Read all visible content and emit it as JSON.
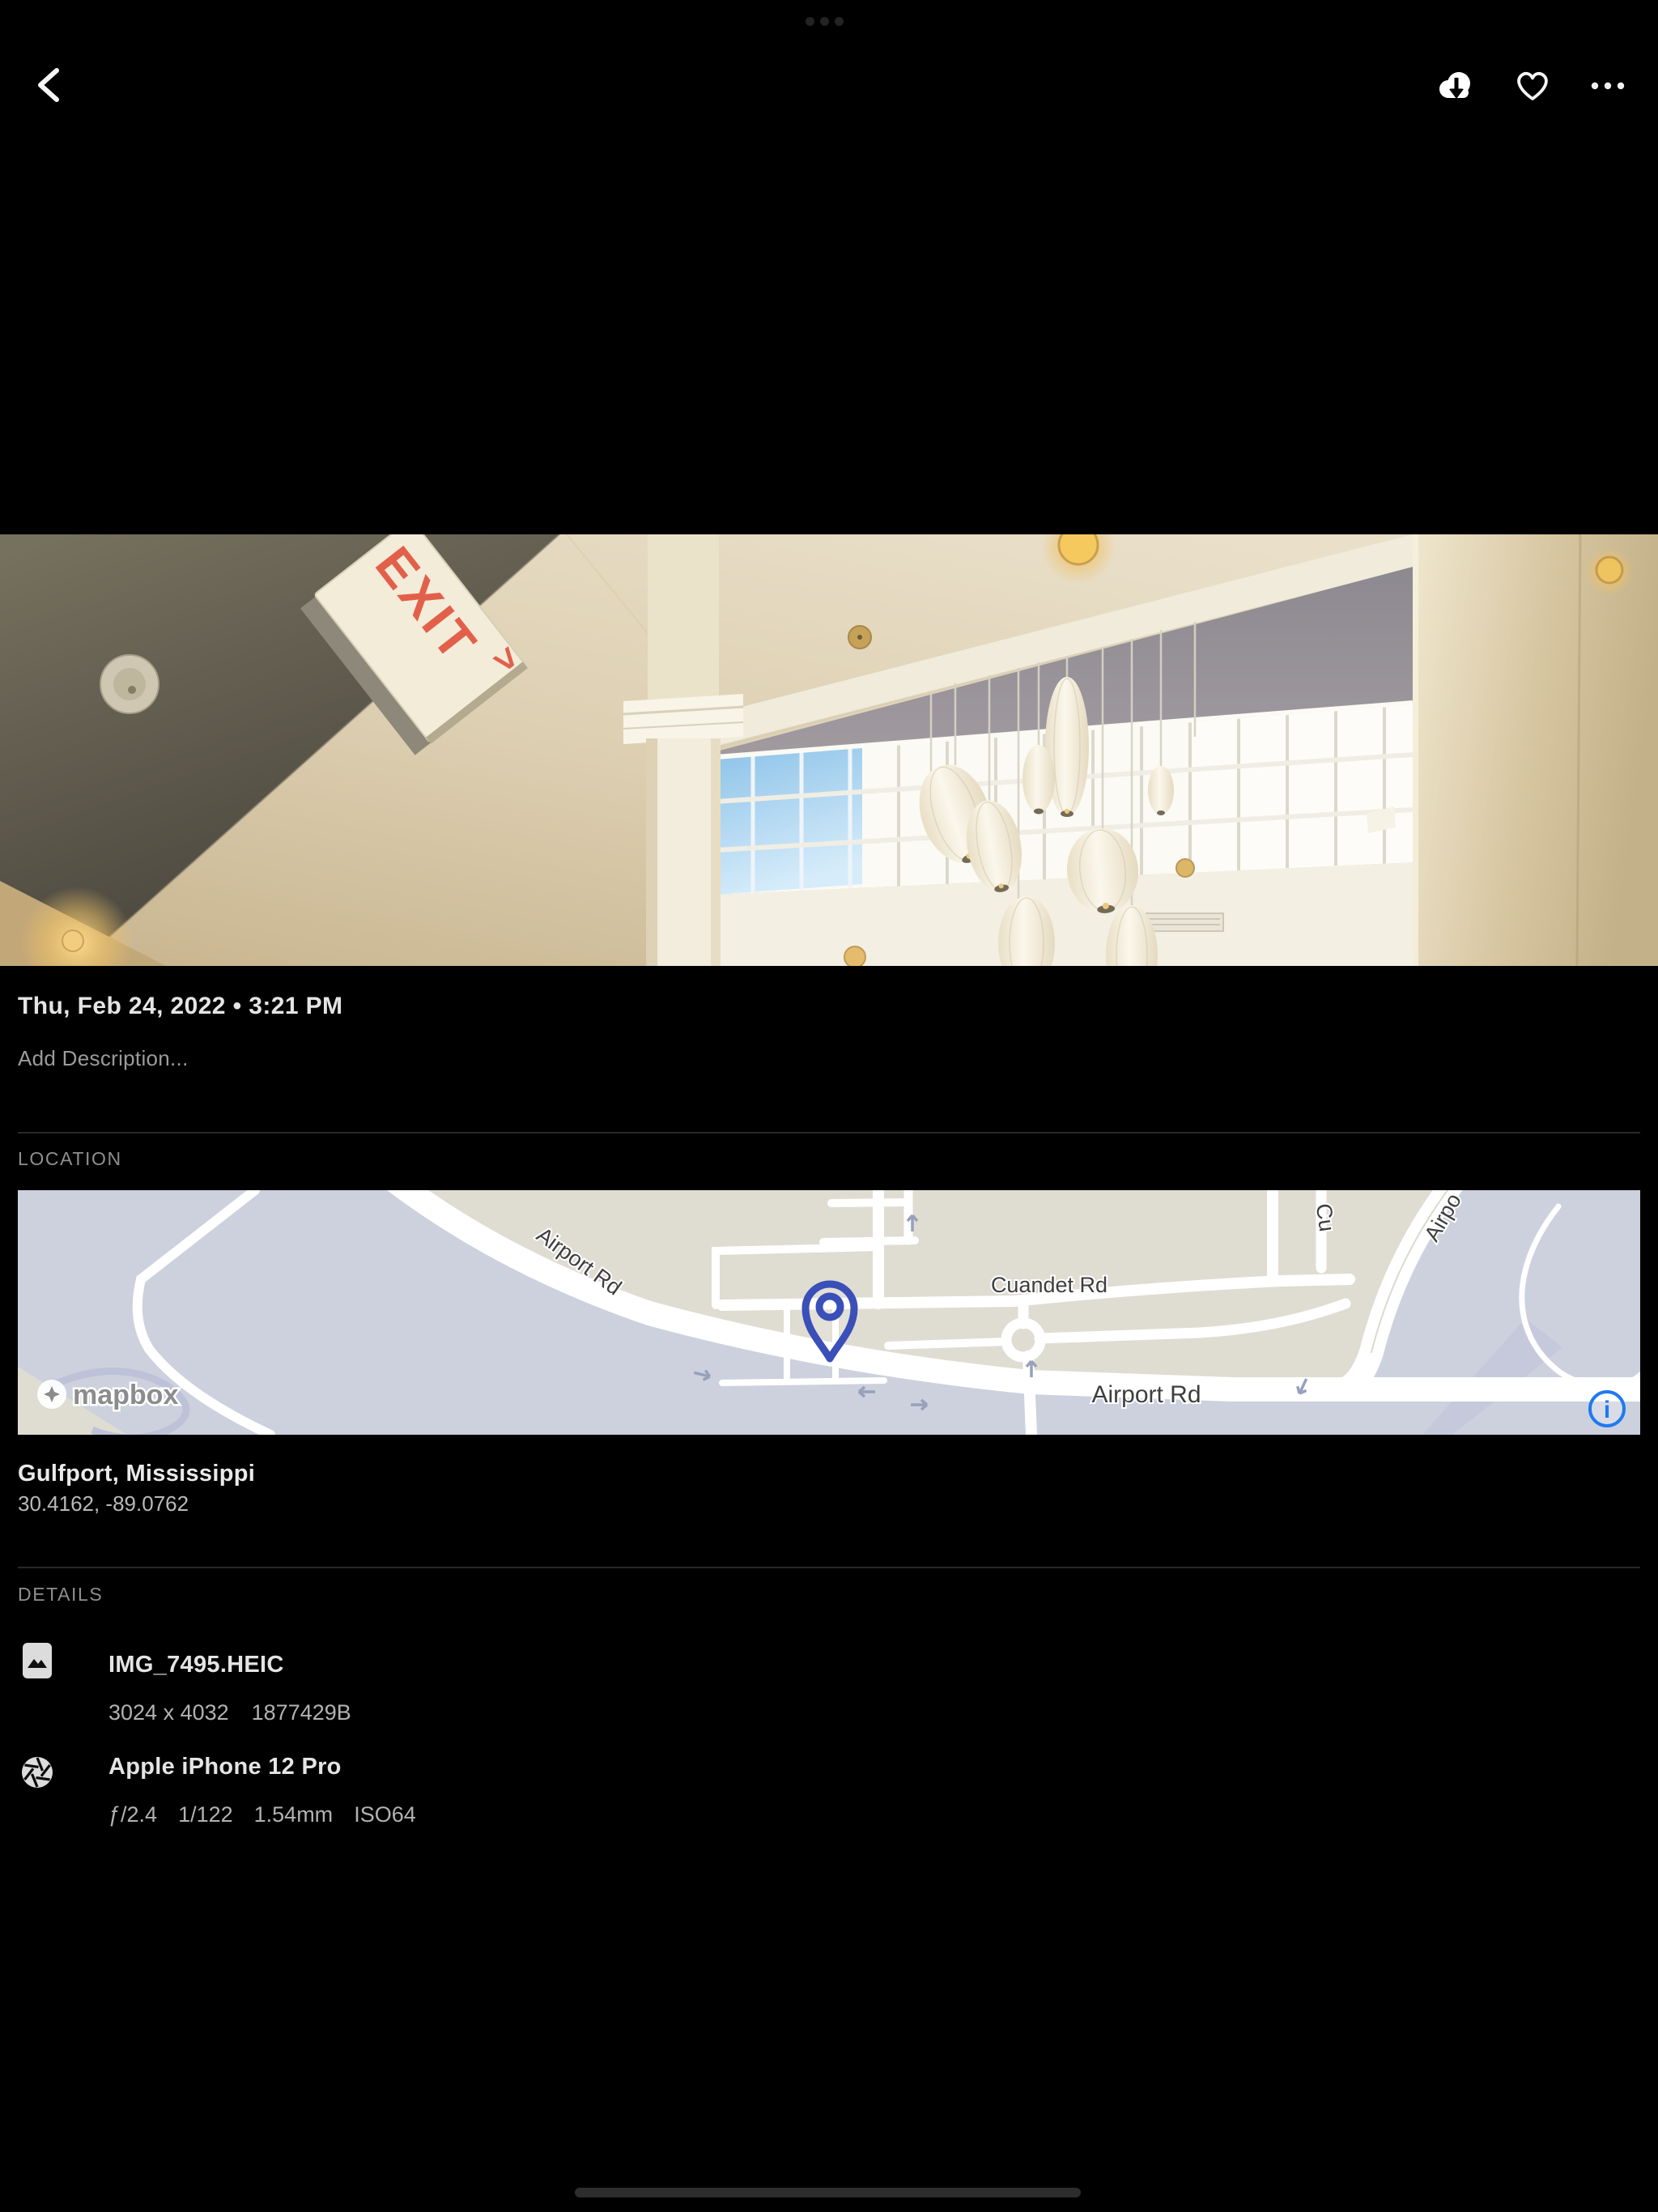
{
  "toolbar": {
    "back_icon": "chevron-left",
    "download_icon": "cloud-download",
    "favorite_icon": "heart-outline",
    "more_icon": "ellipsis"
  },
  "photo": {
    "exit_text": "EXIT",
    "exit_arrow": ">"
  },
  "info": {
    "date": "Thu, Feb 24, 2022 • 3:21 PM",
    "description_placeholder": "Add Description...",
    "location": {
      "heading": "LOCATION",
      "place": "Gulfport, Mississippi",
      "coordinates": "30.4162, -89.0762",
      "map": {
        "attribution": "mapbox",
        "labels": {
          "airport_rd_upper": "Airport Rd",
          "cuandet_rd": "Cuandet Rd",
          "airport_rd_lower": "Airport Rd",
          "airport_rd_diagonal": "Airpo",
          "cross_street": "Cu"
        },
        "colors": {
          "land": "#dfdcd2",
          "base": "#cdd1de",
          "road": "#ffffff",
          "pin": "#3a4fb8",
          "info": "#1e7af0"
        }
      }
    },
    "details": {
      "heading": "DETAILS",
      "file": {
        "name": "IMG_7495.HEIC",
        "dimensions": "3024 x 4032",
        "size": "1877429B"
      },
      "camera": {
        "name": "Apple iPhone 12 Pro",
        "aperture": "ƒ/2.4",
        "shutter": "1/122",
        "focal_length": "1.54mm",
        "iso": "ISO64"
      }
    }
  }
}
